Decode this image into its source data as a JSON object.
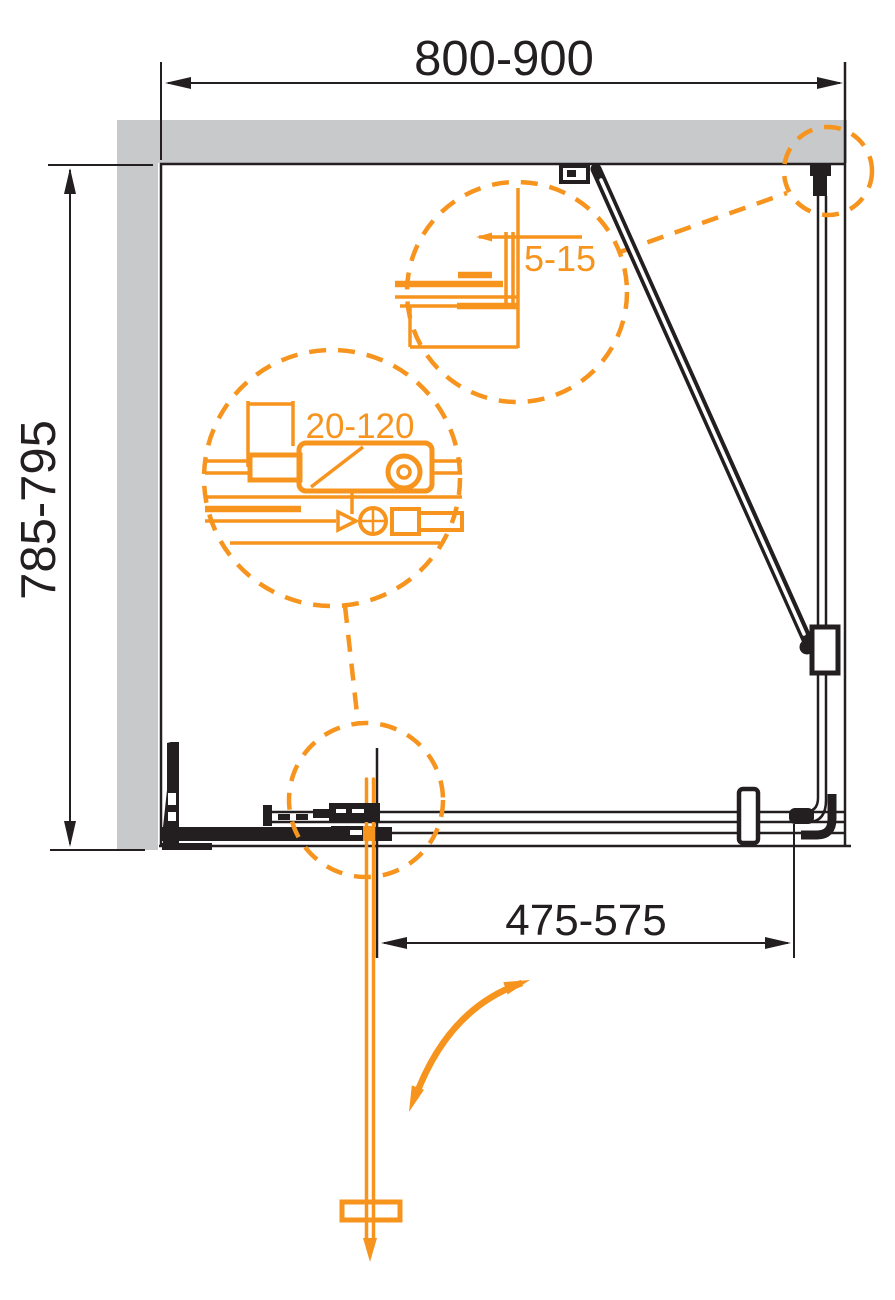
{
  "diagram": {
    "type": "technical-drawing",
    "subject": "shower-enclosure-plan-view",
    "labels": {
      "width_range": "800-900",
      "depth_range": "785-795",
      "door_width_range": "475-575",
      "wall_gap_range": "5-15",
      "adjustment_range": "20-120"
    },
    "colors": {
      "line": "#231f20",
      "wall_fill": "#c8c9cb",
      "accent": "#f7941e",
      "background": "#ffffff"
    }
  }
}
